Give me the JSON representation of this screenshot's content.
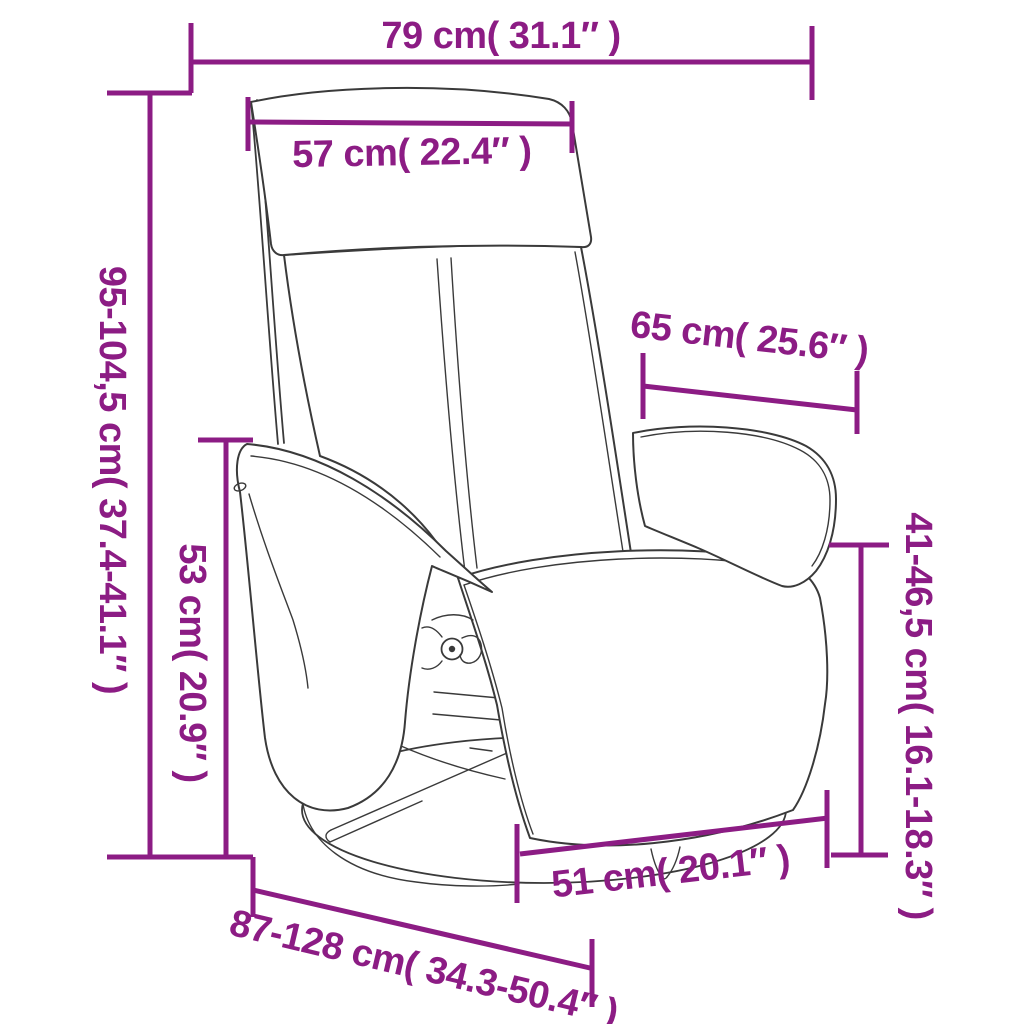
{
  "figure": {
    "title": "Recliner chair with footrest and swivel base — dimension diagram",
    "accent_color": "#8c1c84",
    "line_color": "#3a3a3a",
    "background_color": "#ffffff"
  },
  "dims": {
    "overall_width": {
      "label": "79 cm( 31.1″ )",
      "cm": "79",
      "inches": "31.1"
    },
    "headrest_width": {
      "label": "57 cm( 22.4″ )",
      "cm": "57",
      "inches": "22.4"
    },
    "overall_height": {
      "label": "95-104,5 cm( 37.4-41.1″ )",
      "cm": "95-104,5",
      "inches": "37.4-41.1"
    },
    "armrest_height": {
      "label": "53 cm( 20.9″ )",
      "cm": "53",
      "inches": "20.9"
    },
    "backrest_width": {
      "label": "65 cm( 25.6″ )",
      "cm": "65",
      "inches": "25.6"
    },
    "seat_height": {
      "label": "41-46,5 cm( 16.1-18.3″ )",
      "cm": "41-46,5",
      "inches": "16.1-18.3"
    },
    "base_width": {
      "label": "51 cm( 20.1″ )",
      "cm": "51",
      "inches": "20.1"
    },
    "overall_depth": {
      "label": "87-128 cm( 34.3-50.4″ )",
      "cm": "87-128",
      "inches": "34.3-50.4"
    }
  }
}
